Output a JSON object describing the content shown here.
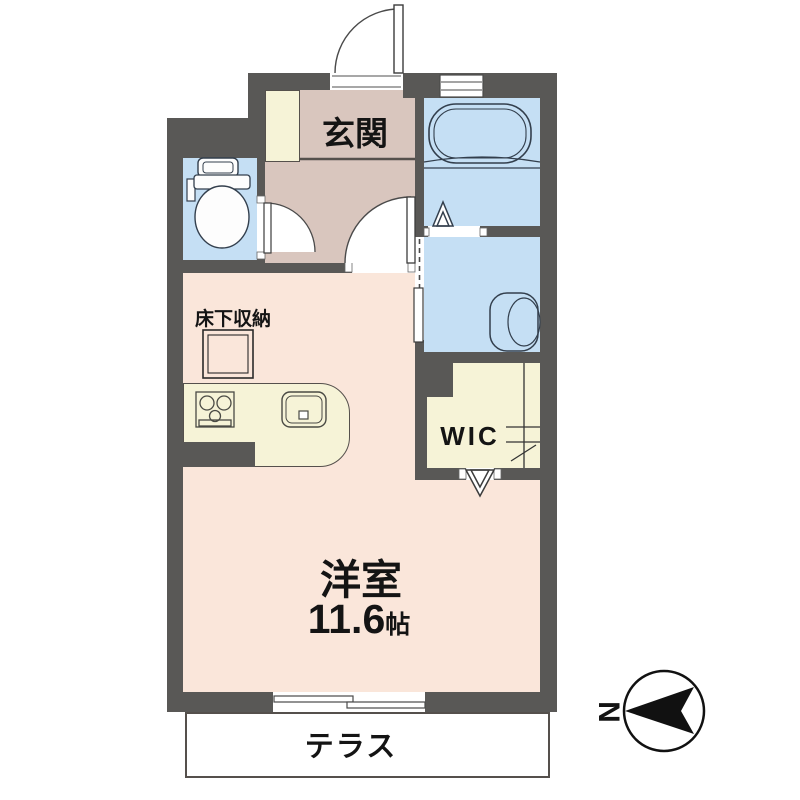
{
  "floorplan": {
    "title": "studio apartment floor plan",
    "genkan": {
      "label": "玄関"
    },
    "underfloor_storage": {
      "label": "床下収納"
    },
    "wic": {
      "label": "WIC"
    },
    "main_room": {
      "label": "洋室",
      "area_value": "11.6",
      "area_unit": "帖"
    },
    "terrace": {
      "label": "テラス"
    },
    "compass": {
      "label": "N",
      "direction": "north-points-left"
    },
    "fixtures": [
      "bathtub",
      "toilet",
      "washbasin",
      "kitchen-sink",
      "gas-stove",
      "underfloor-storage-hatch",
      "closet-hanger"
    ],
    "colors": {
      "wall": "#595856",
      "main_room_floor": "#fae6da",
      "genkan_floor": "#d9c6be",
      "wet_area_floor": "#c5dff4",
      "storage_floor": "#f6f3d7",
      "terrace_floor": "#ffffff",
      "fixture_line": "#333f4d",
      "text": "#141414"
    }
  }
}
